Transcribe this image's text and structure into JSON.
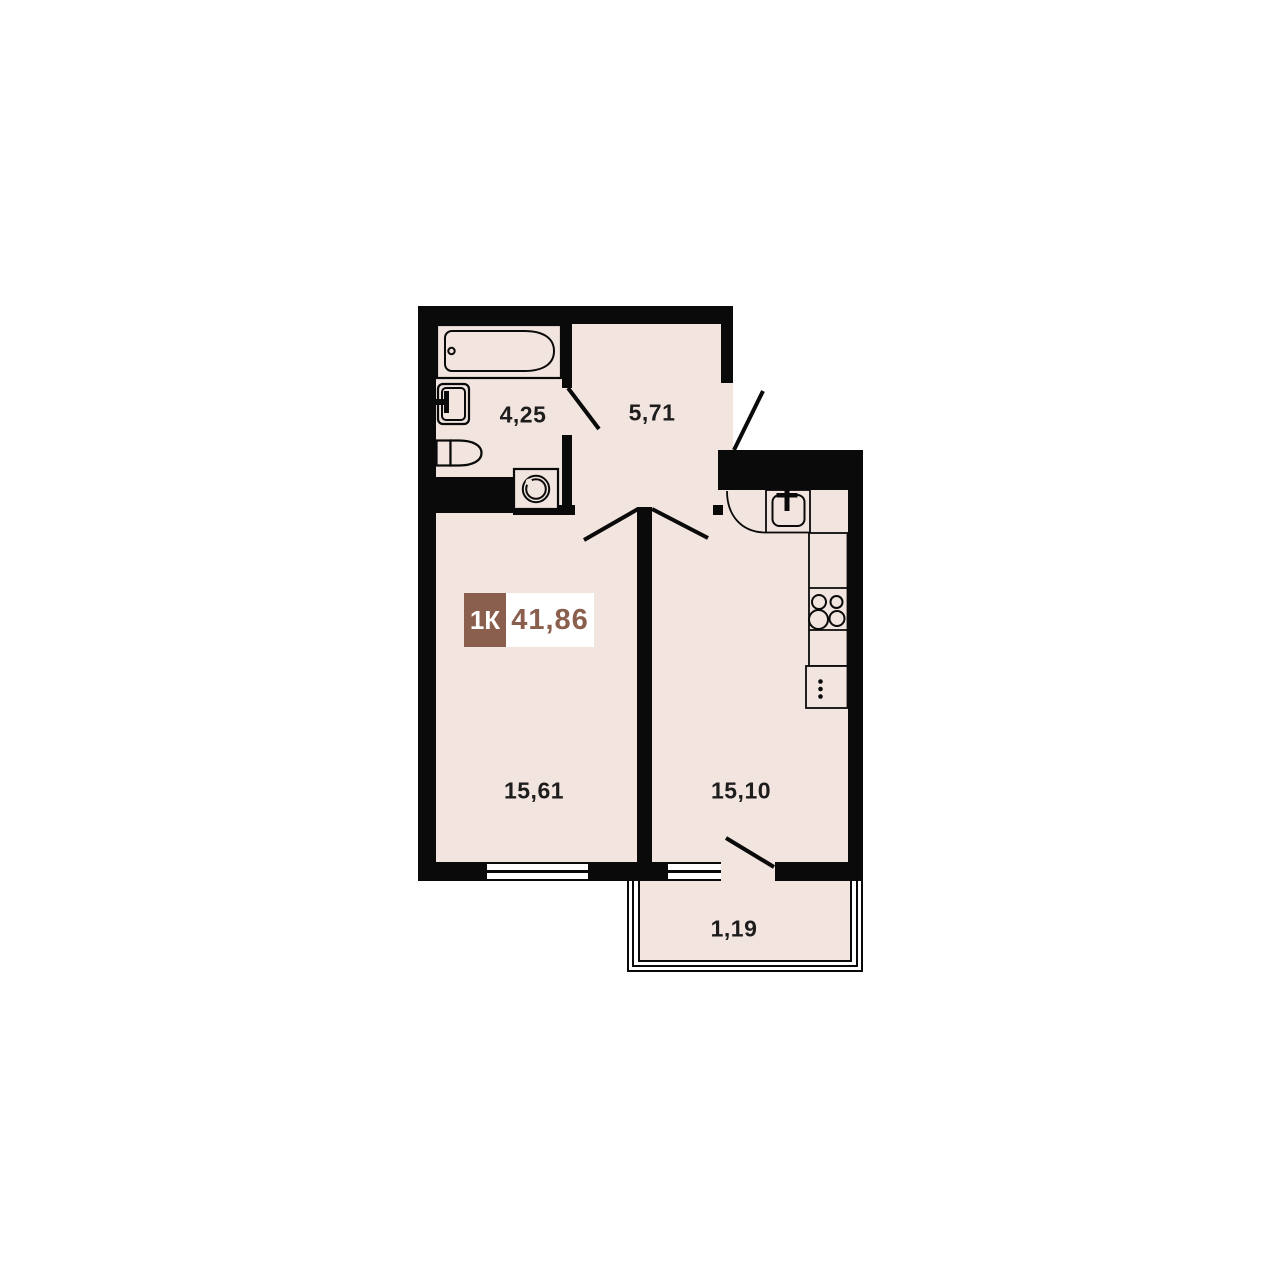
{
  "badge": {
    "rooms_label": "1К",
    "total_area": "41,86"
  },
  "rooms": {
    "bathroom": {
      "name": "bathroom",
      "area": "4,25"
    },
    "hallway": {
      "name": "hallway",
      "area": "5,71"
    },
    "living_room": {
      "name": "living room",
      "area": "15,61"
    },
    "kitchen": {
      "name": "kitchen",
      "area": "15,10"
    },
    "balcony": {
      "name": "balcony",
      "area": "1,19"
    }
  },
  "colors": {
    "background": "#FFFFFF",
    "wall": "#0A0A0A",
    "floor": "#F2E4DE",
    "accent": "#8B5F4D",
    "label": "#1D1D1D"
  }
}
